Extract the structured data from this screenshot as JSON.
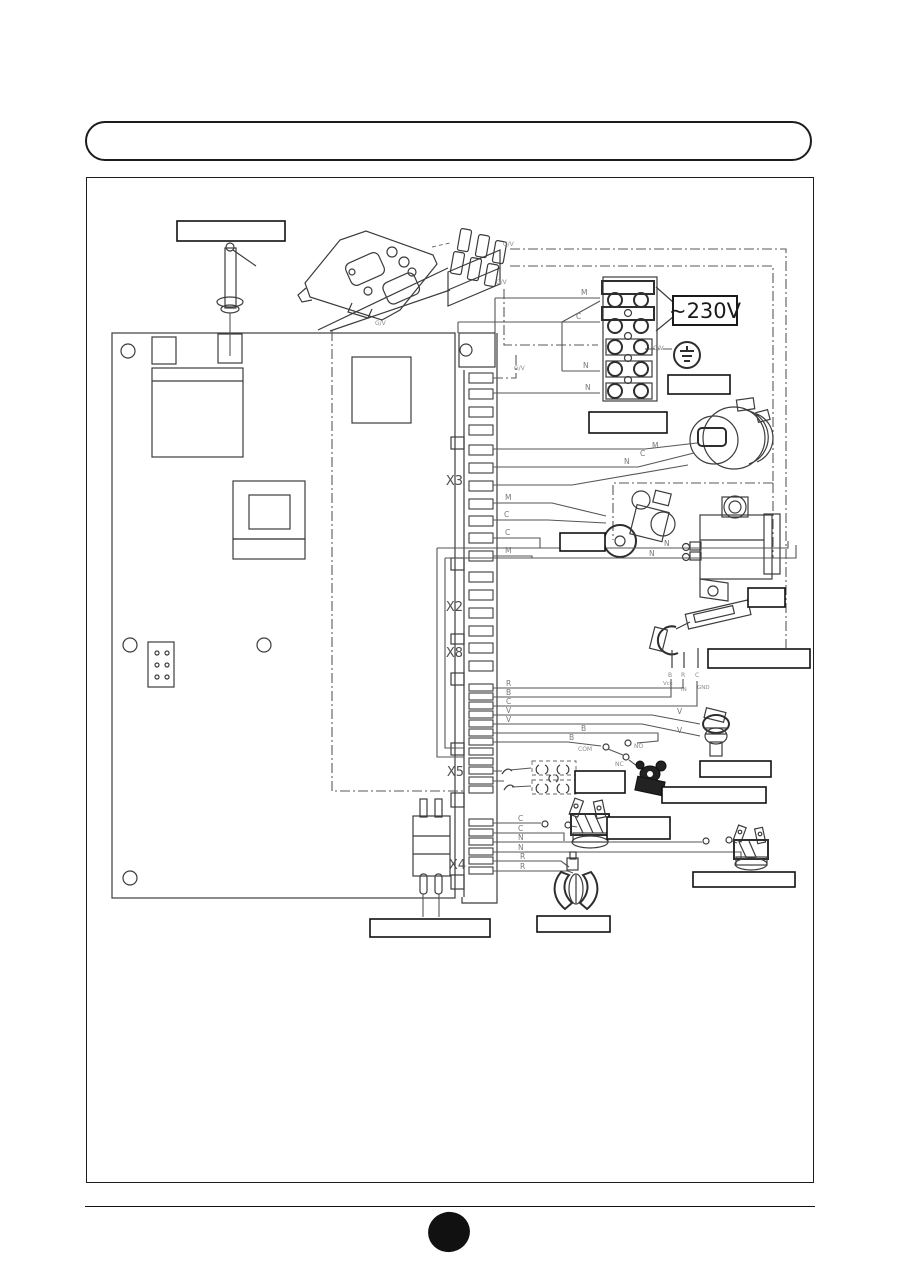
{
  "banner": {
    "title": ""
  },
  "colors": {
    "ink": "#3c3c3c",
    "wire": "#555555",
    "label_text": "#777777"
  },
  "diagram": {
    "voltage": "~230V",
    "earth_code": "G/V",
    "connectors": {
      "x3": "X3",
      "x2": "X2",
      "x8": "X8",
      "x5": "X5",
      "x4": "X4"
    },
    "wire_codes": {
      "m": "M",
      "c": "C",
      "n": "N",
      "r": "R",
      "b": "B",
      "v": "V"
    },
    "switch_contacts": {
      "com": "COM",
      "no": "NO",
      "nc": "NC"
    },
    "sensor_terminals": {
      "b": "B",
      "r": "R",
      "c": "C",
      "vcc": "Vcc",
      "in": "IN",
      "gnd": "GND"
    }
  }
}
